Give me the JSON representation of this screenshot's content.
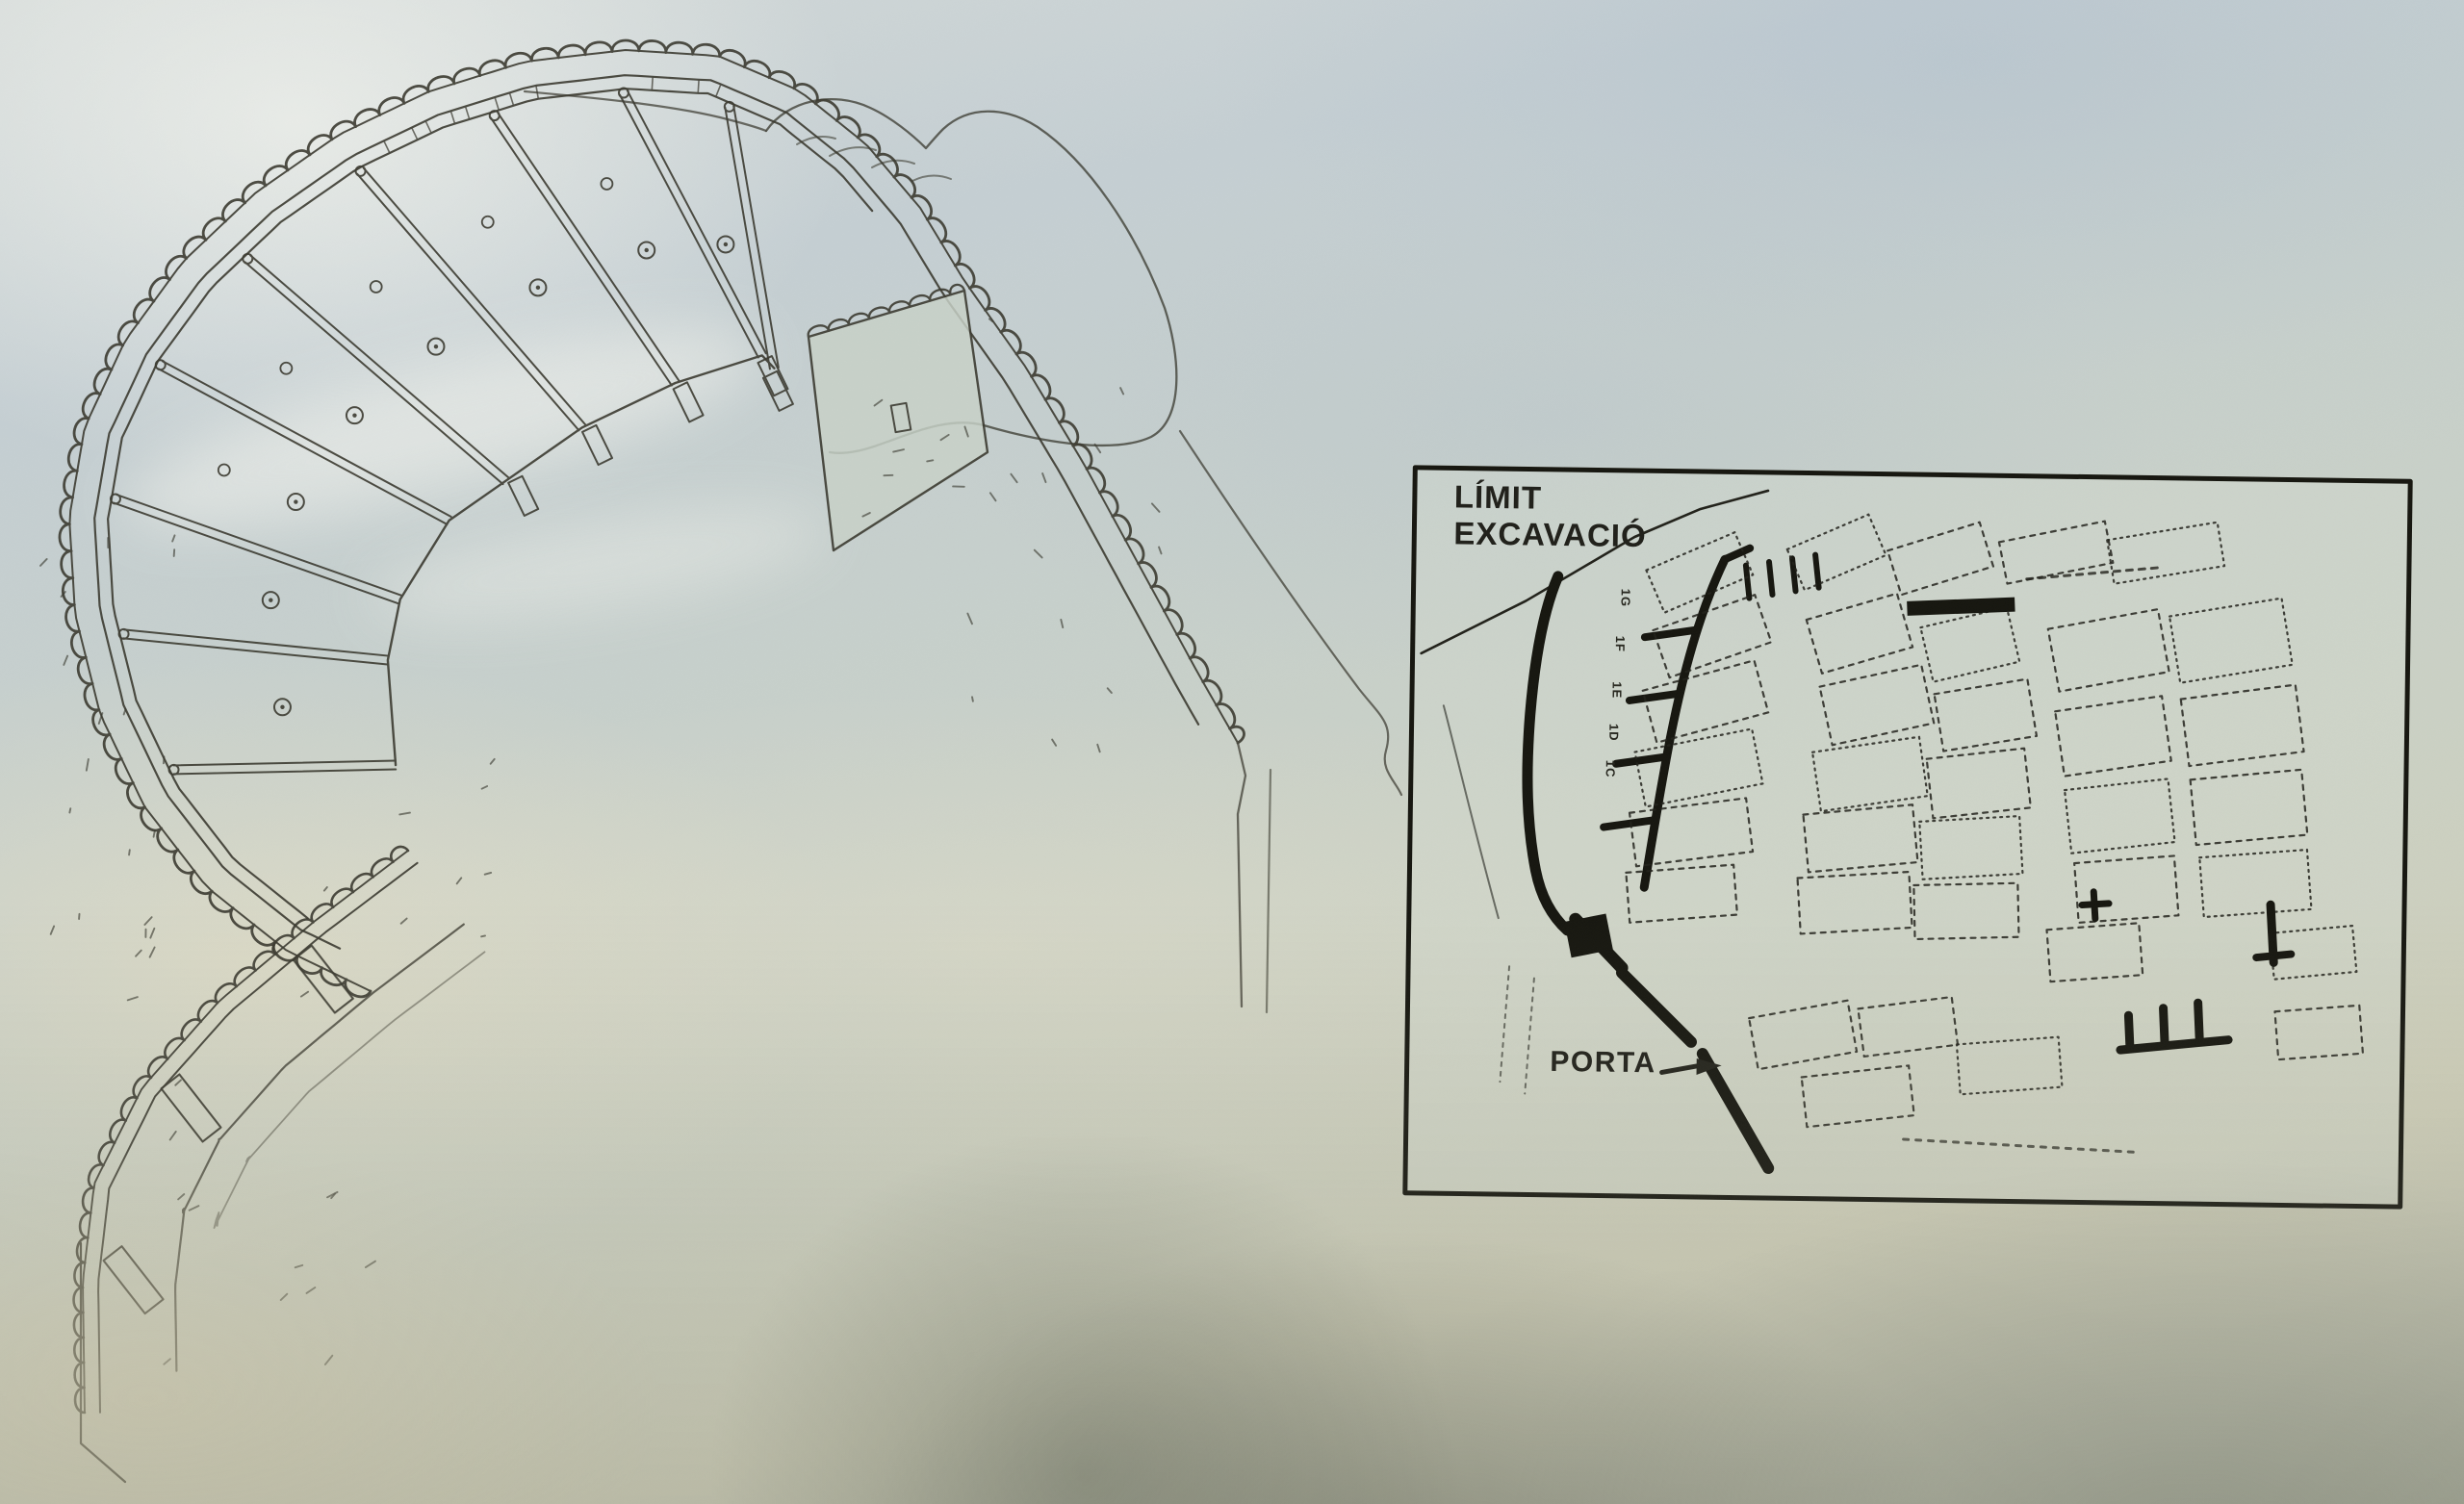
{
  "inset_map": {
    "limit_label": [
      "LÍMIT",
      "EXCAVACIÓ"
    ],
    "porta_label": "PORTA",
    "casemate_room_labels": [
      "1G",
      "1F",
      "1E",
      "1D",
      "1C"
    ]
  },
  "icons": {
    "porta_arrow": "→"
  },
  "colors": {
    "ink": "#3b3a30",
    "map_ink": "#22221b",
    "wall_black": "#16160f",
    "panel_base": "#c7cfcc",
    "haze_sky": "#e9ece6",
    "haze_blue": "#b7c4ce",
    "haze_warm": "#ded5b4",
    "shadow_dark": "#8e978a"
  }
}
